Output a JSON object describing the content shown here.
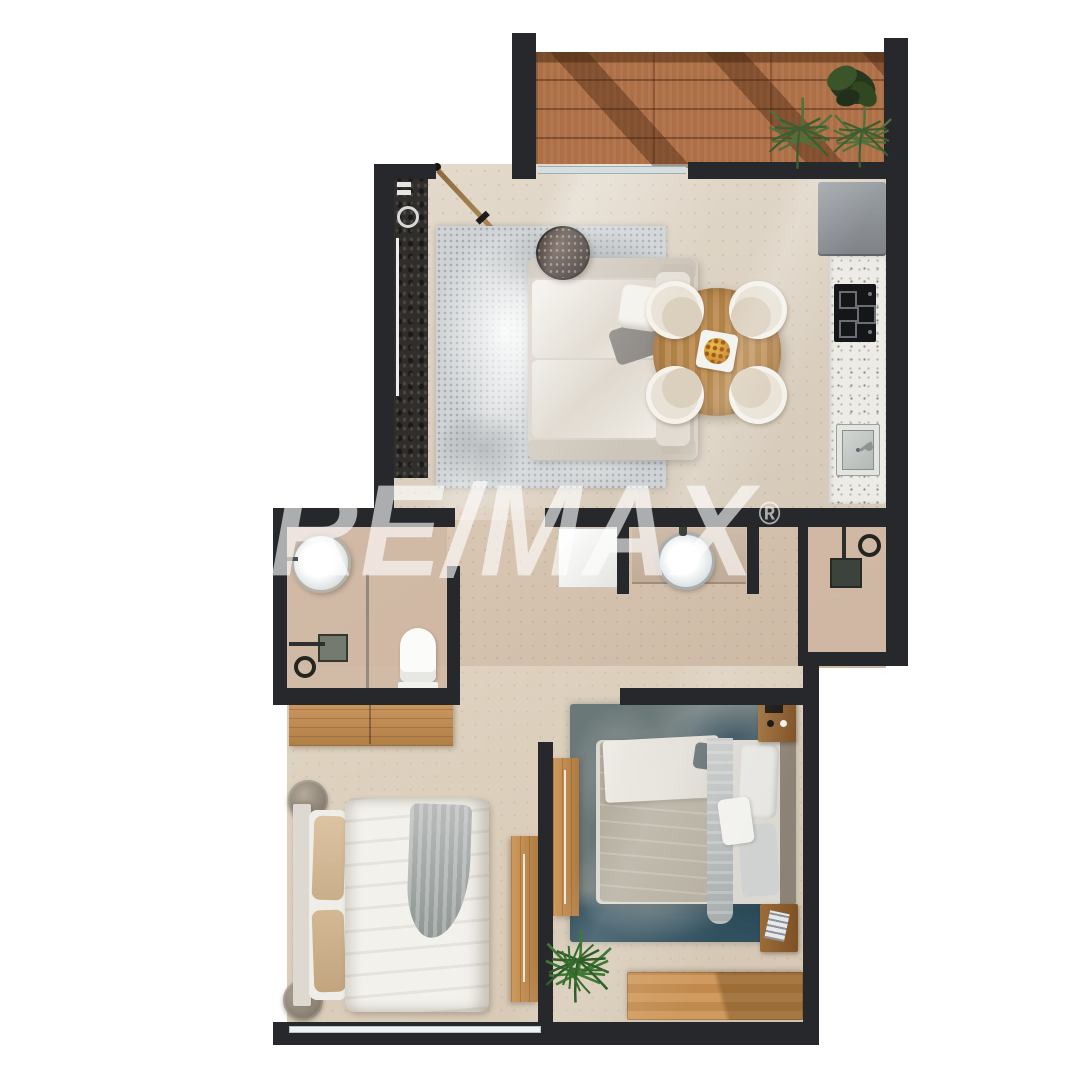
{
  "watermark": {
    "brand": "RE/MAX",
    "registered": "®"
  },
  "palette": {
    "wall": "#26282b",
    "floor-main": "#dbcfbd",
    "floor-mid": "#d4c2af",
    "floor-bath": "#cfb7a3",
    "deck-wood": "#ad6f45",
    "wood": "#c08a52",
    "rug-living": "#cfd3d5",
    "rug-bed": "#6b7878",
    "sofa": "#d7cfc5",
    "linen": "#f3f1ec",
    "terrazzo": "#edebe5",
    "appliance": "#8b8f93",
    "plant": "#4c6b38",
    "watermark": "rgba(255,255,255,0.62)"
  }
}
